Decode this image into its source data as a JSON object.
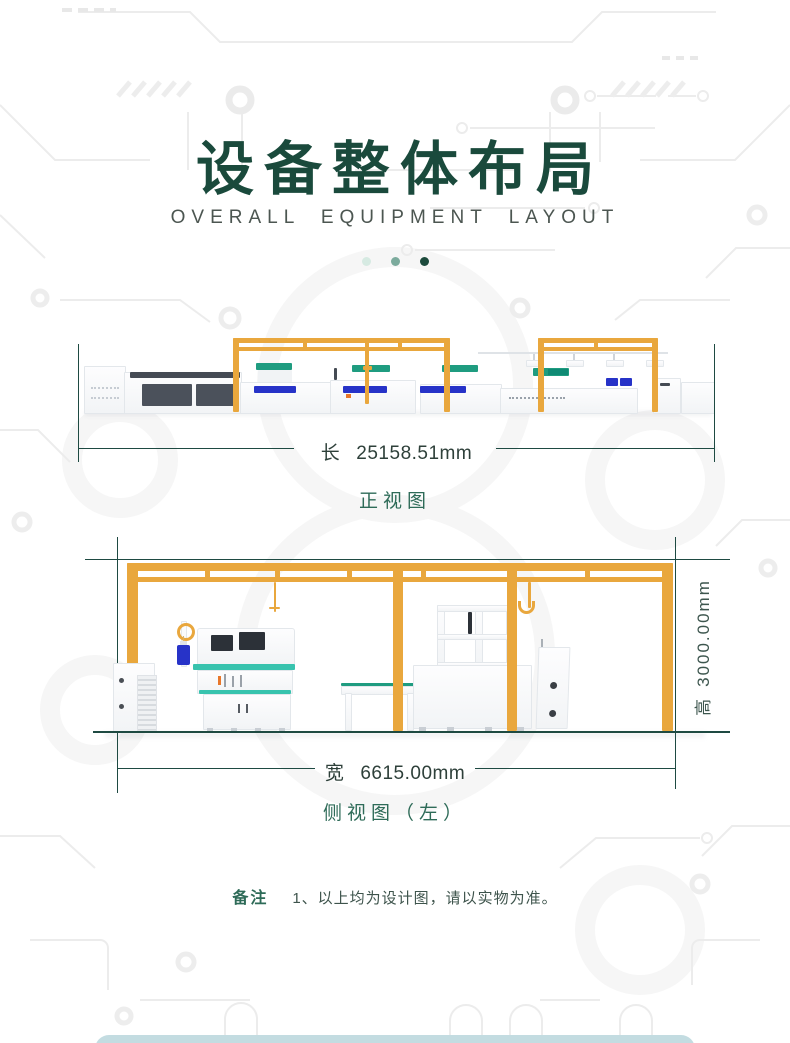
{
  "header": {
    "title": "设备整体布局",
    "subtitle": "OVERALL EQUIPMENT LAYOUT"
  },
  "front_view": {
    "caption": "正视图",
    "length_label": "长",
    "length_value": "25158.51mm"
  },
  "side_view": {
    "caption": "侧视图（左）",
    "width_label": "宽",
    "width_value": "6615.00mm",
    "height_label": "高",
    "height_value": "3000.00mm"
  },
  "note": {
    "label": "备注",
    "text": "1、以上均为设计图，请以实物为准。"
  },
  "colors": {
    "title_green": "#1A4A3C",
    "caption_green": "#2E6B58",
    "dimension_text": "#2E403A",
    "dimension_line": "#1E4A42",
    "gantry_yellow": "#E9A73D",
    "conveyor_green": "#1F9C80",
    "worktop_teal": "#38C3AE",
    "part_blue": "#2733C8",
    "dot_light": "#D6EAE2",
    "dot_mid": "#7CAB9D",
    "dot_dark": "#1C4A3C",
    "circuit_gray": "#ECECEC",
    "bottom_bar": "#C3DCE1"
  }
}
